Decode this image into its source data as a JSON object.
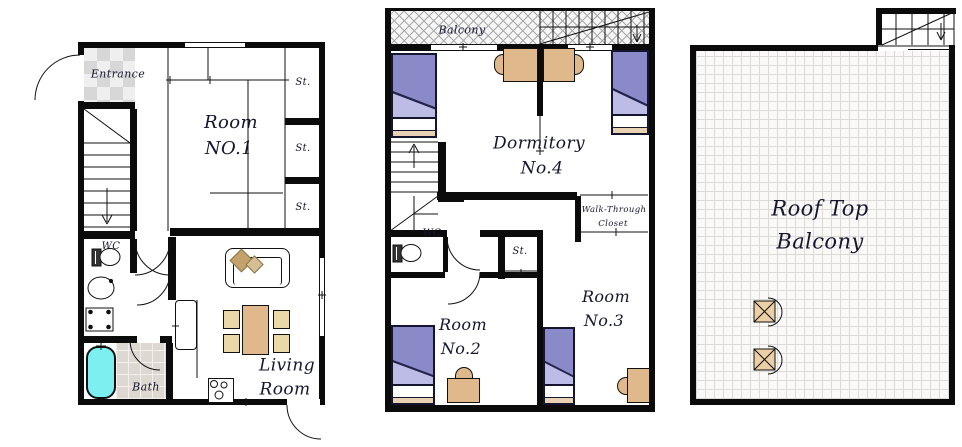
{
  "title": "House floor plan - three levels",
  "floors": {
    "ground": {
      "entrance": "Entrance",
      "room1": [
        "Room",
        "NO.1"
      ],
      "storages": [
        "St.",
        "St.",
        "St."
      ],
      "wc": "WC",
      "bath": "Bath",
      "living_room": [
        "Living",
        "Room"
      ]
    },
    "second": {
      "balcony": "Balcony",
      "dormitory": [
        "Dormitory",
        "No.4"
      ],
      "walk_through_closet": [
        "Walk-Through",
        "Closet"
      ],
      "wc": "WC",
      "storage": "St.",
      "room2": [
        "Room",
        "No.2"
      ],
      "room3": [
        "Room",
        "No.3"
      ]
    },
    "roof": {
      "label": [
        "Roof Top",
        "Balcony"
      ]
    }
  },
  "icons": {
    "stairs_down_arrow": "stairs-direction-arrow-down",
    "stairs_up_arrow": "stairs-direction-arrow-up",
    "door_arc": "door-swing-arc",
    "toilet": "toilet-icon",
    "sink": "sink-icon",
    "washing_machine": "washing-machine-icon",
    "bathtub": "bathtub-icon",
    "sofa": "sofa-icon",
    "dining_table": "dining-table-icon",
    "stove": "stove-icon",
    "bed": "single-bed-icon",
    "desk_chair": "desk-with-chair-icon",
    "balcony_chair": "balcony-chair-icon"
  },
  "colors": {
    "wall": "#0b0b0b",
    "bed_blanket": "#8a8ac8",
    "bed_fold": "#bcbce6",
    "bed_foot": "#e9d2b3",
    "pillow": "#ffffff",
    "desk_wood": "#dfb98b",
    "dining_chair": "#ead8a8",
    "bathtub": "#7cf0f0",
    "sofa_cushion_dark": "#c3a36b",
    "sofa_cushion_light": "#d5bd94",
    "entrance_tile": "#d7d7d7",
    "bath_tile": "#ddd8d2",
    "roof_grid": "#dcdad7",
    "hatch_line": "#a8a8a8"
  }
}
